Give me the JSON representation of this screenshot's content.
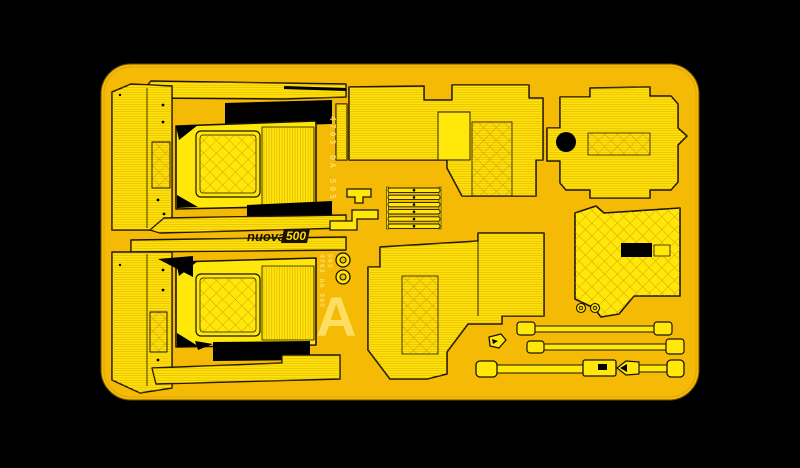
{
  "image": {
    "width": 800,
    "height": 468,
    "background_color": "#000000",
    "description": "Yellow photo-etched detail fret (sheet A) for a Nuova 500 scale-model interior, photographed on a black background"
  },
  "fret": {
    "base_color": "#F5BA06",
    "part_color": "#FFE70A",
    "etch_line_color": "#1A1400",
    "texture_line_color": "#D69500",
    "marking_color": "#FFE878",
    "cutout_color": "#000000"
  },
  "markings": {
    "logo_script": "nuova",
    "logo_number": "500",
    "sheet_letter": "A",
    "code_top_vertical": "4703 DA 505",
    "code_side_line1": "4703 DA 505",
    "code_side_line2": "505"
  },
  "parts": {
    "labels": [
      "seat-assembly-top-left",
      "seat-assembly-bottom-left",
      "quilted-seat-back",
      "side-panel-ribbed",
      "floor-mat-center-top",
      "floor-mat-center-bottom",
      "engine-bay-mat-top-right",
      "side-mat-right-middle",
      "ladder-grille",
      "z-bracket",
      "retainer-cap",
      "mounting-rings",
      "straps",
      "triangle-clip",
      "sill-strip"
    ]
  }
}
